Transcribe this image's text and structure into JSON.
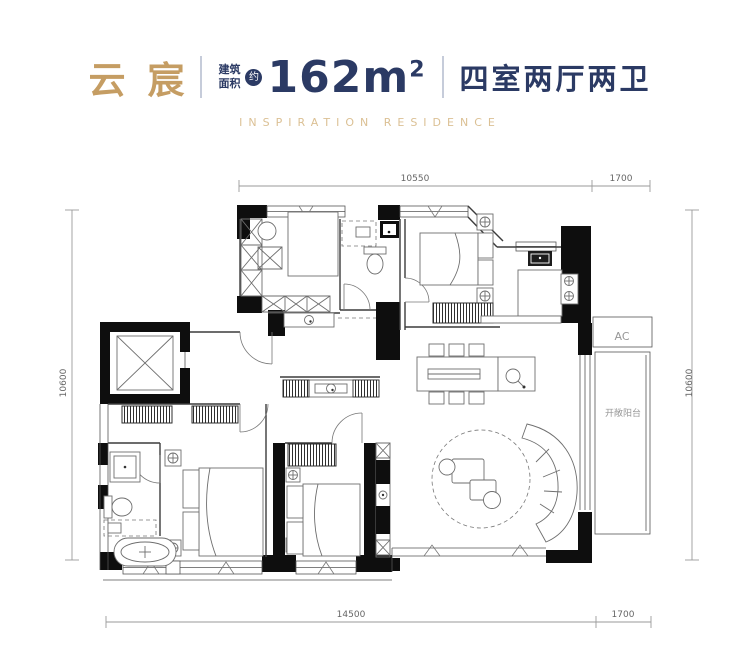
{
  "header": {
    "project_name": "云宸",
    "area_prefix_top": "建筑",
    "area_prefix_bottom": "面积",
    "approx_badge": "约",
    "area_value": "162m",
    "area_unit_sup": "2",
    "apartment_type": "四室两厅两卫",
    "subtitle": "INSPIRATION RESIDENCE"
  },
  "colors": {
    "brand_gold": "#C59D63",
    "subtitle_gold": "#DBC094",
    "brand_navy": "#2B3A64",
    "wall_black": "#0E0E0E",
    "dimension_gray": "#9A9A9A"
  },
  "floorplan": {
    "dim_top_main": "10550",
    "dim_top_right": "1700",
    "dim_bottom_main": "14500",
    "dim_bottom_right": "1700",
    "dim_left": "10600",
    "dim_right": "10600",
    "label_ac": "AC",
    "label_balcony": "开敞阳台"
  }
}
